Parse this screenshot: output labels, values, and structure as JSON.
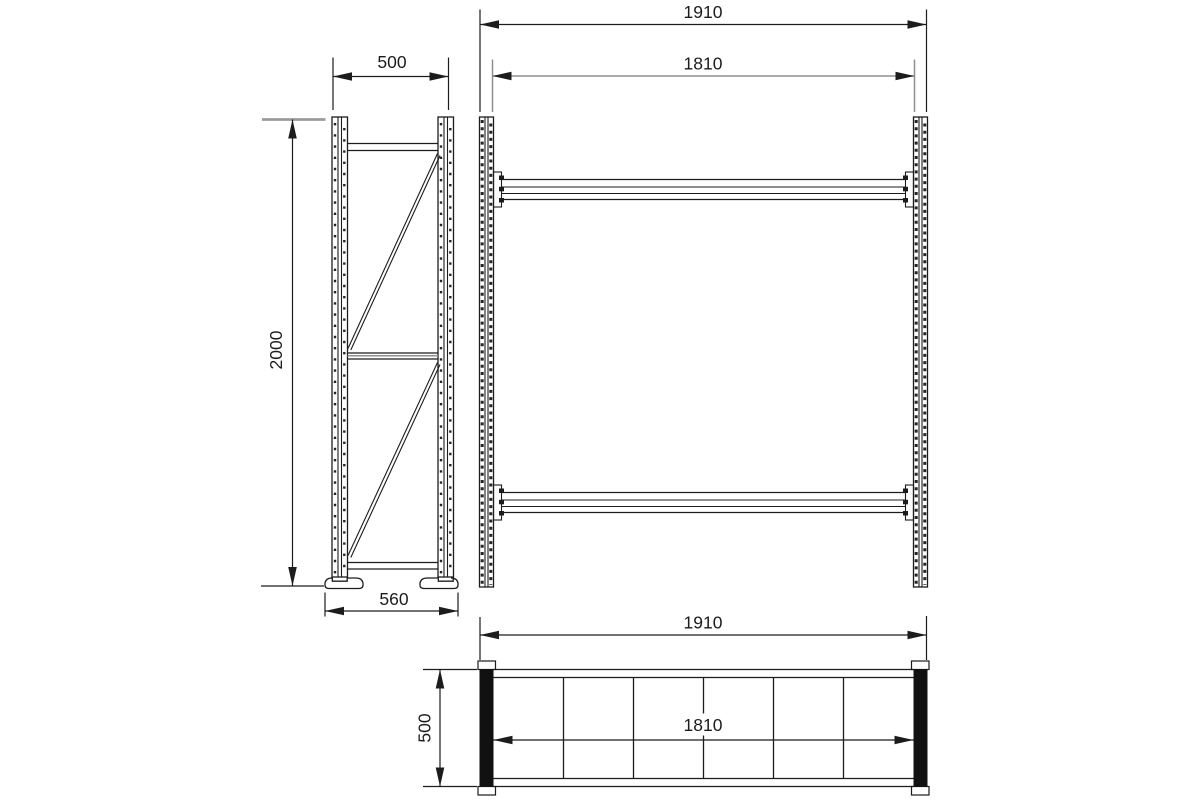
{
  "drawing": {
    "type": "technical-drawing",
    "colors": {
      "line": "#1c1c1c",
      "gray_line": "#9b9b9b",
      "background": "#ffffff",
      "post_fill": "#111111"
    },
    "side_view": {
      "dimensions": {
        "frame_width": "500",
        "frame_height": "2000",
        "base_width": "560"
      }
    },
    "front_view": {
      "dimensions": {
        "overall_width": "1910",
        "beam_width": "1810"
      }
    },
    "plan_view": {
      "dimensions": {
        "overall_width": "1910",
        "beam_width": "1810",
        "depth": "500"
      }
    }
  }
}
